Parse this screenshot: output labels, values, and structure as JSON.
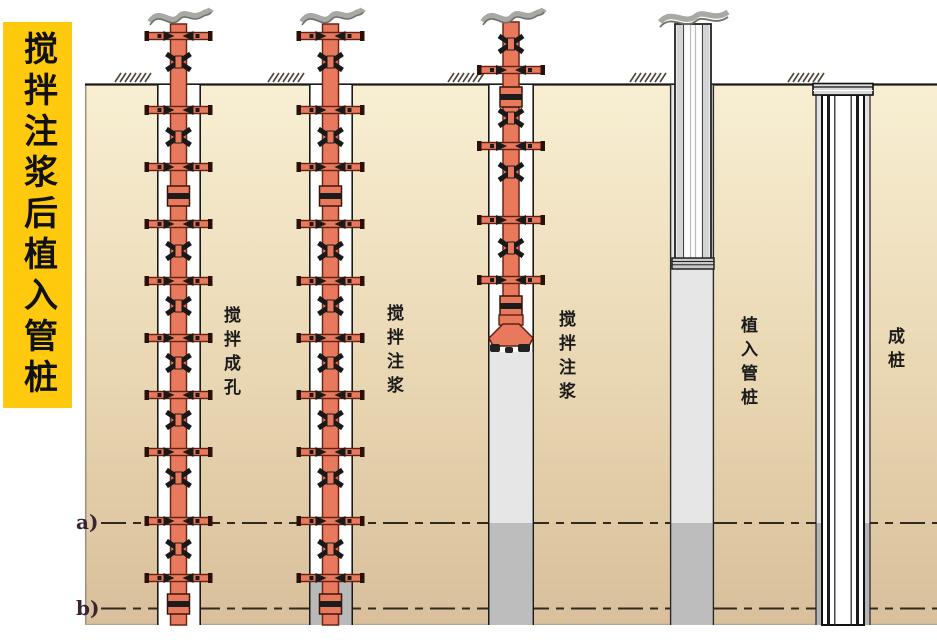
{
  "banner": {
    "text": "搅拌注浆后植入管桩"
  },
  "stages": [
    {
      "label": "搅拌成孔"
    },
    {
      "label": "搅拌注浆"
    },
    {
      "label": "搅拌注浆"
    },
    {
      "label": "植入管桩"
    },
    {
      "label": "成桩"
    }
  ],
  "markers": [
    {
      "label": "a)"
    },
    {
      "label": "b)"
    }
  ],
  "colors": {
    "banner_bg": "#FFC90E",
    "banner_text": "#111111",
    "soil_top": "#F8EFD3",
    "soil_bottom": "#D9BF9B",
    "auger_red": "#E8795C",
    "auger_outline": "#5F2212",
    "grout_light": "#E6E6E6",
    "grout_dark": "#BDBDBD",
    "pile2_grout": "#B9B9B9",
    "borehole": "#FFFFFF",
    "ground_line": "#1B1B1B",
    "dashed_line": "#2E2A1E"
  }
}
